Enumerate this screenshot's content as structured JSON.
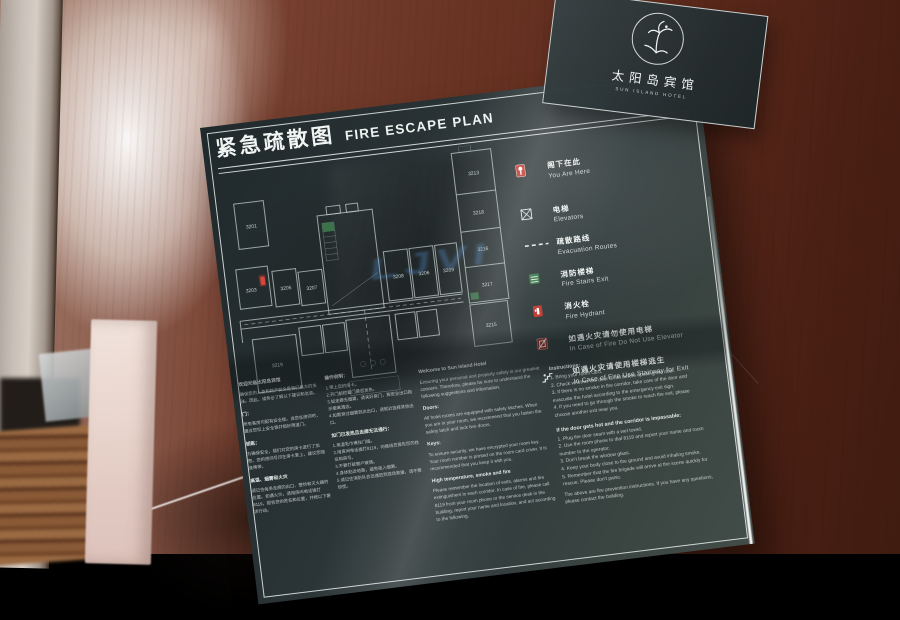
{
  "hotel": {
    "name_zh": "太阳岛宾馆",
    "name_en": "SUN ISLAND HOTEL"
  },
  "title": {
    "zh": "紧急疏散图",
    "en": "FIRE ESCAPE PLAN"
  },
  "watermark": "LJVI",
  "legend": {
    "items": [
      {
        "zh": "阁下在此",
        "en": "You Are Here"
      },
      {
        "zh": "电梯",
        "en": "Elevators"
      },
      {
        "zh": "疏散路线",
        "en": "Evacuation Routes"
      },
      {
        "zh": "消防楼梯",
        "en": "Fire Stairs Exit"
      },
      {
        "zh": "消火栓",
        "en": "Fire Hydrant"
      },
      {
        "zh": "如遇火灾请勿使用电梯",
        "en": "In Case of Fire Do Not Use Elevator"
      },
      {
        "zh": "如遇火灾请使用楼梯逃生",
        "en": "In Case of Fire Use Stairway for Exit"
      }
    ]
  },
  "floor_plan": {
    "rooms": [
      {
        "n": "3201"
      },
      {
        "n": "3203"
      },
      {
        "n": "3205"
      },
      {
        "n": "3207"
      },
      {
        "n": "3208"
      },
      {
        "n": "3206"
      },
      {
        "n": "3209"
      },
      {
        "n": "3213"
      },
      {
        "n": "3218"
      },
      {
        "n": "3216"
      },
      {
        "n": "3217"
      },
      {
        "n": "3215"
      },
      {
        "n": "3219"
      }
    ]
  },
  "info": {
    "cn1": {
      "h1": "欢迎光临太阳岛宾馆",
      "p1": "确保您的人身和财产安全是我们最大的关注。因此，请务必了解以下建议和信息。",
      "h2": "门：",
      "p2": "所有客房均配有安全锁。当您在房间时，建议您扣上安全锁并锁好两道门。",
      "h3": "钥匙：",
      "p3": "为确保安全，我们对您的房卡进行了加密。您的房间号印在房卡套上，建议您随身携带。",
      "h4": "高温、烟雾和火灾",
      "p4": "请记住每条走廊的出口、警铃和灭火器的位置。如遇火灾，请用房间电话拨打8119，报告您的姓名和位置，并按以下要求行动。"
    },
    "cn2": {
      "h1": "操作说明：",
      "p1": "1.带上您的房卡。\n2.开门前检查门是否发热。\n3.如走廊无烟雾，请关好房门，按安全出口指示撤离酒店。\n4.如需穿过烟雾到达出口，请就近选择其他出口。",
      "h2": "如门已发热且走廊无法通行：",
      "p2": "1.用湿毛巾堵住门缝。\n2.用房间电话拨打8119，向接线员报告您的姓名和房号。\n3.不要打破窗户玻璃。\n4.身体贴近地面，避免吸入烟雾。\n5.请记住消防队会迅速赶到现场救援，请不要惊慌。"
    },
    "welcome": {
      "h1": "Welcome to Sun Island Hotel",
      "p1": "Ensuring your personal and property safety is our greatest concern. Therefore, please be sure to understand the following suggestions and information.",
      "doors_h": "Doors:",
      "doors_p": "All hotel rooms are equipped with safety latches. When you are in your room, we recommend that you fasten the safety latch and lock two doors.",
      "keys_h": "Keys:",
      "keys_p": "To ensure security, we have encrypted your room key. Your room number is printed on the room card cover. It is recommended that you keep it with you.",
      "fire_h": "High temperature, smoke and fire",
      "fire_p": "Please remember the location of exits, alarms and fire extinguishers in each corridor. In case of fire, please call 8119 from your room phone or the service desk in the building, report your name and location, and act according to the following."
    },
    "instructions": {
      "h1": "Instructions:",
      "p1": "1. Bring your room card.\n2. Check whether the door is hot before opening the door.\n3. If there is no smoke in the corridor, take care of the door and evacuate the hotel according to the emergency exit sign.\n4. If you need to go through the smoke to reach the exit, please choose another exit near you.",
      "h2": "If the door gets hot and the corridor is impassable:",
      "p2": "1. Plug the door seam with a wet towel.\n2. Use the room phone to dial 8119 and report your name and room number to the operator.\n3. Don't break the window glass.\n4. Keep your body close to the ground and avoid inhaling smoke.\n5. Remember that the fire brigade will arrive at the scene quickly for rescue. Please don't panic.",
      "tail": "The above are fire prevention instructions. If you have any questions, please contact the building."
    }
  },
  "colors": {
    "sign_background": "#2b3436",
    "accent_red": "#c0392f",
    "accent_green": "#3f7a4e",
    "watermark_blue": "#5692d6",
    "wood_brown": "#6a3424"
  }
}
